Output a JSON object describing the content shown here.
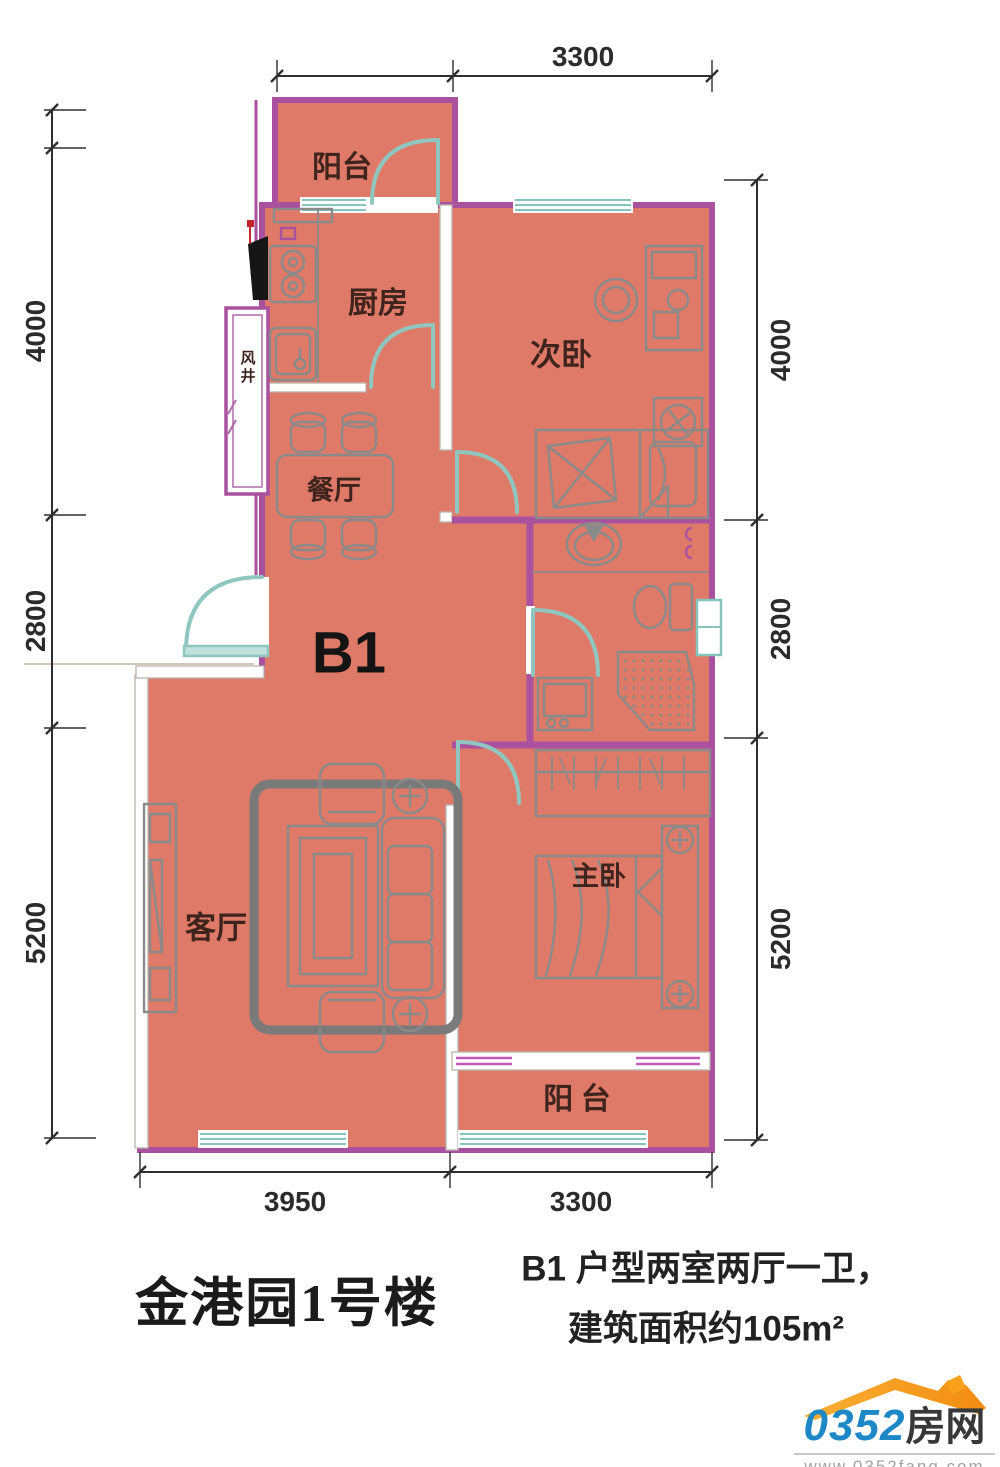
{
  "plan": {
    "unit_label": "B1",
    "rooms": {
      "balcony_top": "阳台",
      "kitchen": "厨房",
      "bedroom2": "次卧",
      "air_shaft": "风井",
      "dining": "餐厅",
      "living": "客厅",
      "master": "主卧",
      "balcony_bottom": "阳 台"
    },
    "dimensions": {
      "top": "3300",
      "left": [
        "4000",
        "2800",
        "5200"
      ],
      "right": [
        "4000",
        "2800",
        "5200"
      ],
      "bottom": [
        "3950",
        "3300"
      ]
    }
  },
  "footer": {
    "building_title": "金港园1号楼",
    "desc_line1": "B1 户型两室两厅一卫，",
    "desc_line2": "建筑面积约105m²"
  },
  "logo": {
    "number": "0352",
    "suffix": "房网",
    "url": "www.0352fang.com"
  },
  "colors": {
    "floor": "#df7a68",
    "wall": "#a9519f",
    "window_teal": "#84c6be",
    "door_teal": "#8fc7c0",
    "dim_line": "#2e2e2e",
    "furniture": "#8a8a8a",
    "logo_orange": "#f9a01b",
    "logo_blue": "#1e88c7"
  }
}
